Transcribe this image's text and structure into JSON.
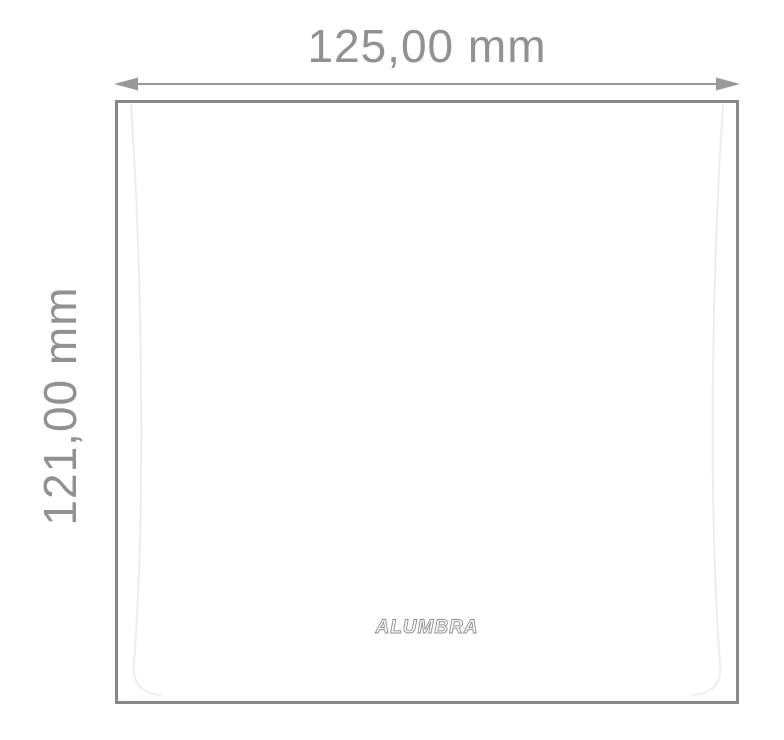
{
  "diagram": {
    "width_label": "125,00 mm",
    "height_label": "121,00 mm",
    "brand_logo": "ALUMBRA",
    "colors": {
      "background": "#ffffff",
      "dimension_text": "#8f9194",
      "arrow": "#97999c",
      "plate_border": "#85878a",
      "face_line": "#ededf0",
      "logo_stroke": "#8a8c8e"
    }
  }
}
